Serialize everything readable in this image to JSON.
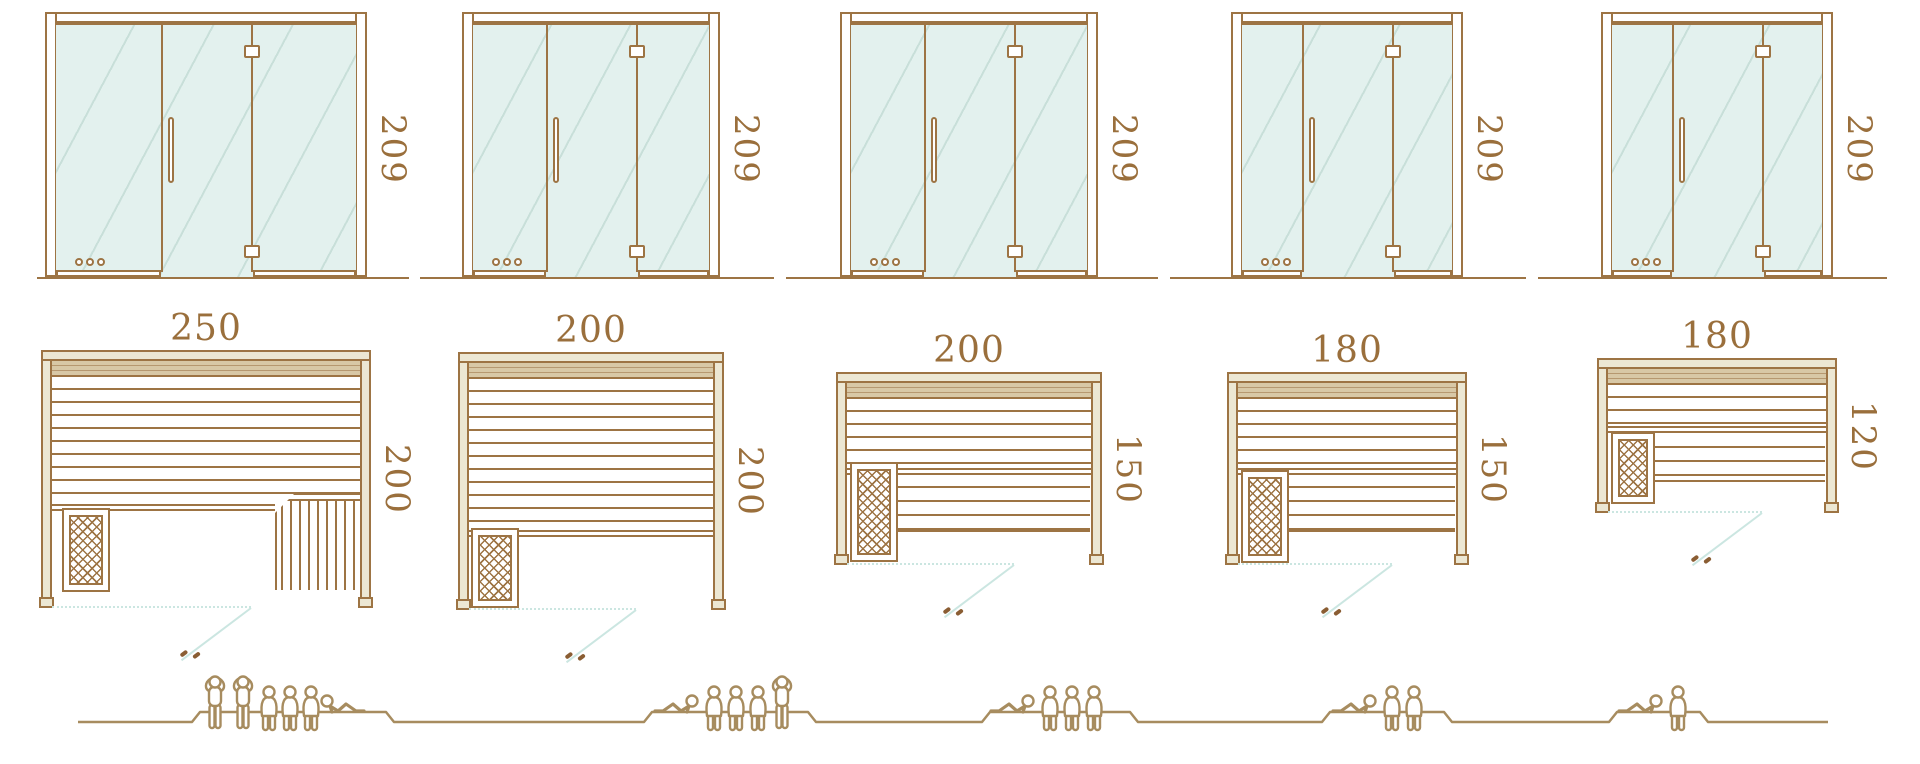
{
  "colors": {
    "line_brown": "#9d7444",
    "dimension_text": "#9a6f3c",
    "glass_fill": "#e3f1ee",
    "wall_fill": "#ece7d3",
    "backrest_fill": "#d8c8a6",
    "door_swing_cyan": "#cbe6e1",
    "handle_mark": "#8a5d33",
    "people_outline": "#a78c5f",
    "background": "#ffffff"
  },
  "units": [
    {
      "name": "sauna-250x200",
      "elevation": {
        "height_label": "209"
      },
      "plan": {
        "width_label": "250",
        "depth_label": "200"
      },
      "capacity": {
        "standing": 2,
        "seated": 3,
        "lying": 1,
        "total": 6
      }
    },
    {
      "name": "sauna-200x200",
      "elevation": {
        "height_label": "209"
      },
      "plan": {
        "width_label": "200",
        "depth_label": "200"
      },
      "capacity": {
        "standing": 1,
        "seated": 3,
        "lying": 1,
        "total": 5
      }
    },
    {
      "name": "sauna-200x150",
      "elevation": {
        "height_label": "209"
      },
      "plan": {
        "width_label": "200",
        "depth_label": "150"
      },
      "capacity": {
        "standing": 0,
        "seated": 3,
        "lying": 1,
        "total": 4
      }
    },
    {
      "name": "sauna-180x150",
      "elevation": {
        "height_label": "209"
      },
      "plan": {
        "width_label": "180",
        "depth_label": "150"
      },
      "capacity": {
        "standing": 0,
        "seated": 2,
        "lying": 1,
        "total": 3
      }
    },
    {
      "name": "sauna-180x120",
      "elevation": {
        "height_label": "209"
      },
      "plan": {
        "width_label": "180",
        "depth_label": "120"
      },
      "capacity": {
        "standing": 0,
        "seated": 1,
        "lying": 1,
        "total": 2
      }
    }
  ]
}
